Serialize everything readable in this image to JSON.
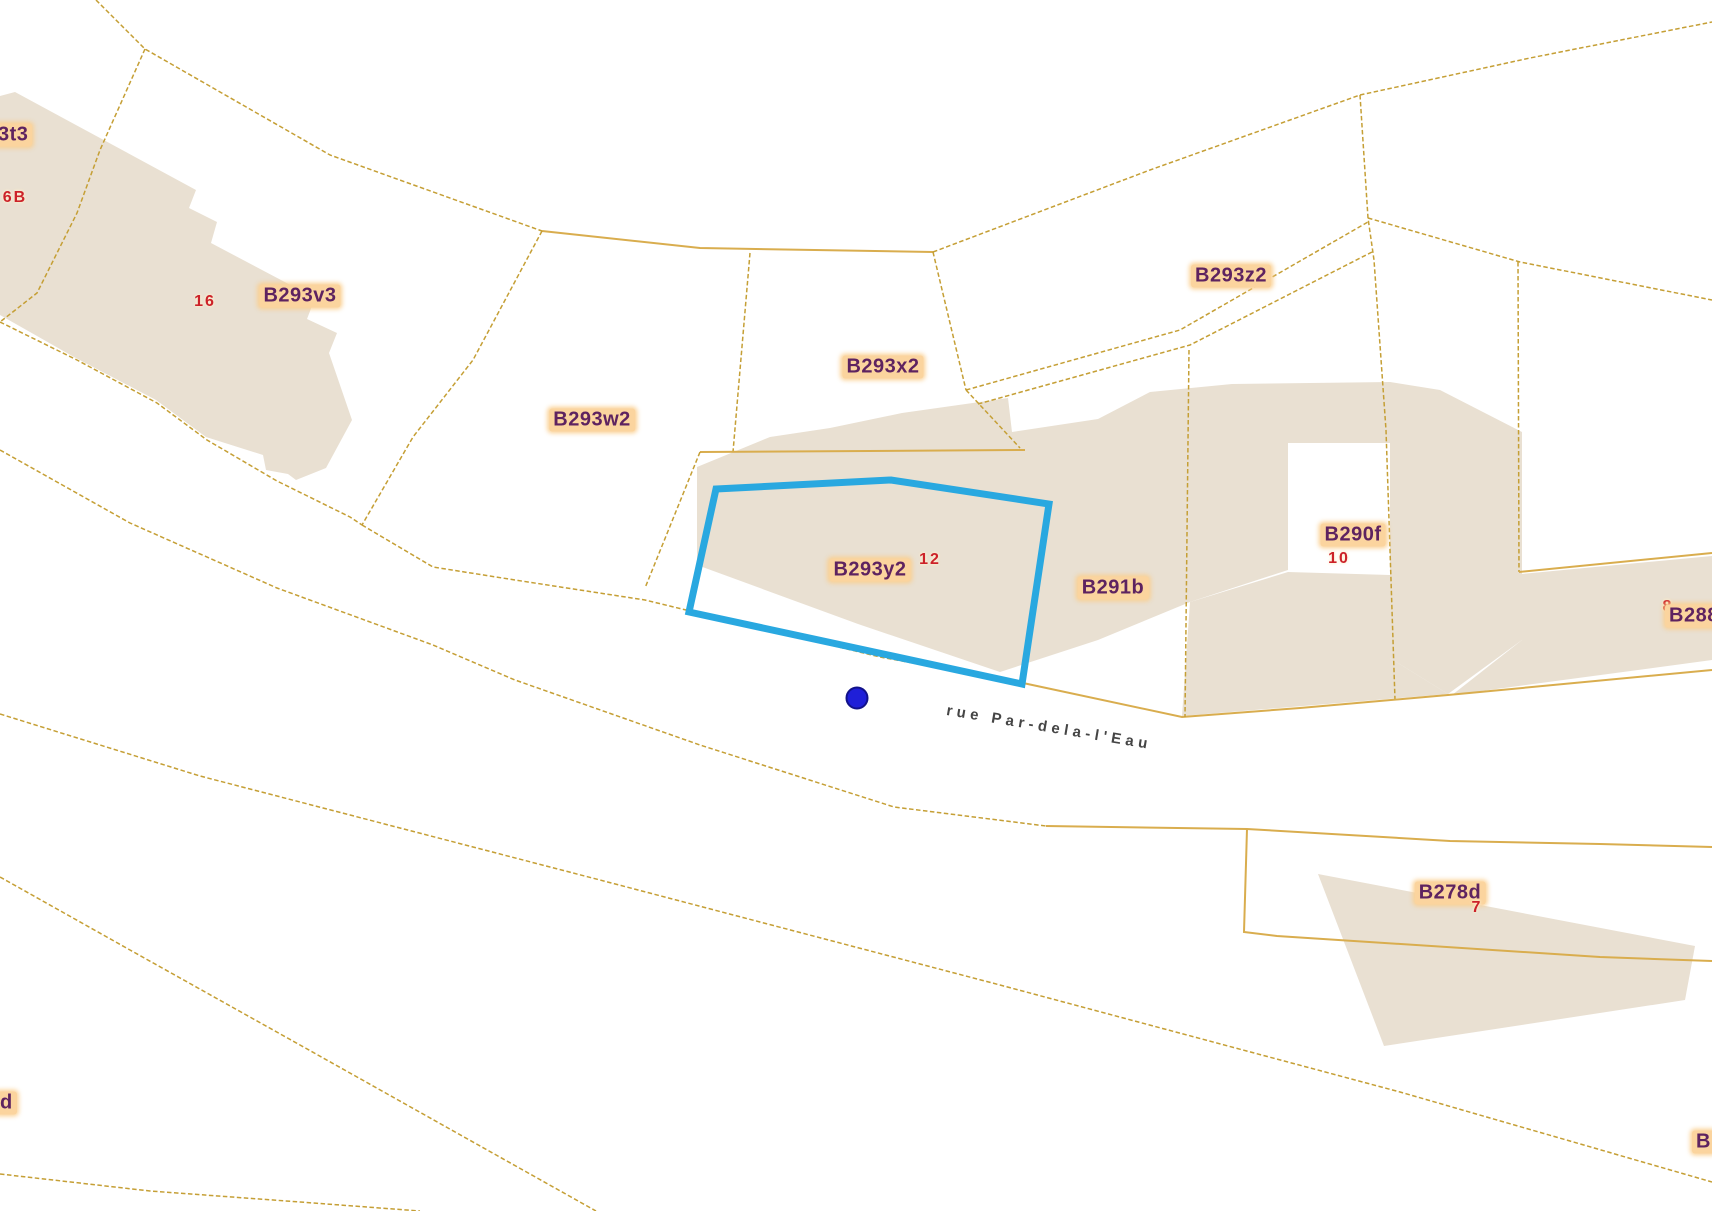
{
  "map": {
    "title": "cadastral-parcel-map",
    "colors": {
      "background": "#ffffff",
      "building_fill": "#e9e0d2",
      "boundary_line": "#c59f35",
      "boundary_line_solid": "#d9ad4e",
      "parcel_label_text": "#5e2360",
      "parcel_label_bg": "#fbd49e",
      "house_number_text": "#cc2229",
      "street_text": "#454545",
      "highlight_outline": "#29a8e0",
      "marker_fill": "#1f1fd8",
      "marker_border": "#12128a"
    },
    "street": {
      "name": "rue Par-dela-l'Eau",
      "x": 948,
      "y": 702,
      "rotation_deg": 9.5
    },
    "marker": {
      "x": 857,
      "y": 698,
      "radius": 11
    },
    "selected_parcel": {
      "id": "B293y2",
      "outline_points": "716,489 891,480 1049,504 1022,684 689,612",
      "stroke_width": 7
    },
    "labels": [
      {
        "id": "parcel-b293t3-partial",
        "kind": "parcel",
        "text": "3t3",
        "x": -6,
        "y": 135,
        "align": "left"
      },
      {
        "id": "house-6b",
        "kind": "house",
        "text": "6B",
        "x": 15,
        "y": 198,
        "align": "center"
      },
      {
        "id": "house-16",
        "kind": "house",
        "text": "16",
        "x": 205,
        "y": 302,
        "align": "center"
      },
      {
        "id": "parcel-b293v3",
        "kind": "parcel",
        "text": "B293v3",
        "x": 300,
        "y": 296,
        "align": "center"
      },
      {
        "id": "parcel-b293w2",
        "kind": "parcel",
        "text": "B293w2",
        "x": 592,
        "y": 420,
        "align": "center"
      },
      {
        "id": "parcel-b293x2",
        "kind": "parcel",
        "text": "B293x2",
        "x": 883,
        "y": 367,
        "align": "center"
      },
      {
        "id": "parcel-b293z2",
        "kind": "parcel",
        "text": "B293z2",
        "x": 1231,
        "y": 276,
        "align": "center"
      },
      {
        "id": "parcel-b293y2",
        "kind": "parcel",
        "text": "B293y2",
        "x": 870,
        "y": 570,
        "align": "center"
      },
      {
        "id": "house-12",
        "kind": "house",
        "text": "12",
        "x": 930,
        "y": 560,
        "align": "center"
      },
      {
        "id": "parcel-b291b",
        "kind": "parcel",
        "text": "B291b",
        "x": 1113,
        "y": 588,
        "align": "center"
      },
      {
        "id": "parcel-b290f",
        "kind": "parcel",
        "text": "B290f",
        "x": 1353,
        "y": 535,
        "align": "center"
      },
      {
        "id": "house-10",
        "kind": "house",
        "text": "10",
        "x": 1339,
        "y": 559,
        "align": "center"
      },
      {
        "id": "house-8",
        "kind": "house",
        "text": "8",
        "x": 1668,
        "y": 607,
        "align": "center"
      },
      {
        "id": "parcel-b288-partial",
        "kind": "parcel",
        "text": "B288",
        "x": 1665,
        "y": 616,
        "align": "left"
      },
      {
        "id": "parcel-b278d",
        "kind": "parcel",
        "text": "B278d",
        "x": 1450,
        "y": 893,
        "align": "center"
      },
      {
        "id": "house-7",
        "kind": "house",
        "text": "7",
        "x": 1477,
        "y": 908,
        "align": "center"
      },
      {
        "id": "parcel-d-partial",
        "kind": "parcel",
        "text": "d",
        "x": -4,
        "y": 1103,
        "align": "left"
      },
      {
        "id": "parcel-b-partial",
        "kind": "parcel",
        "text": "B",
        "x": 1692,
        "y": 1142,
        "align": "left"
      }
    ],
    "buildings": [
      {
        "id": "building-top-left",
        "points": "15,92 196,190 189,208 217,222 211,243 315,298 307,319 337,333 329,353 352,420 326,468 296,480 288,474 266,470 263,455 206,437 156,400 74,357 0,315 0,96"
      },
      {
        "id": "building-central",
        "points": "697,467 770,437 830,428 902,413 1008,398 1012,432 1098,419 1098,640 1000,672 858,624 697,565"
      },
      {
        "id": "building-b290f-left",
        "points": "1098,419 1150,392 1232,384 1390,382 1390,443 1288,443 1288,570 1190,602 1098,640"
      },
      {
        "id": "building-b290f-right",
        "points": "1390,382 1440,390 1522,432 1522,640 1448,694 1390,658"
      },
      {
        "id": "building-bottom-band",
        "points": "1190,602 1288,572 1390,575 1390,658 1448,694 1182,716"
      },
      {
        "id": "building-right-strip",
        "points": "1522,574 1712,556 1712,660 1452,695 1522,640"
      },
      {
        "id": "building-b278d",
        "points": "1318,874 1695,946 1685,1000 1384,1046"
      }
    ],
    "boundary_lines": [
      {
        "id": "l1",
        "style": "dashed",
        "points": "96,0 145,49 330,155 542,231"
      },
      {
        "id": "l2",
        "style": "solid",
        "points": "542,231 700,248 933,252"
      },
      {
        "id": "l3",
        "style": "dashed",
        "points": "933,252 1150,170 1360,95"
      },
      {
        "id": "l4",
        "style": "dashed",
        "points": "1360,95 1368,218 1374,260 1386,430 1395,700"
      },
      {
        "id": "l5",
        "style": "dashed",
        "points": "1360,95 1530,58 1712,22"
      },
      {
        "id": "l6",
        "style": "dashed",
        "points": "1368,218 1520,262 1712,300"
      },
      {
        "id": "l7",
        "style": "dashed",
        "points": "750,253 733,452"
      },
      {
        "id": "l8",
        "style": "solid",
        "points": "700,452 1025,450"
      },
      {
        "id": "l9",
        "style": "dashed",
        "points": "700,452 645,588"
      },
      {
        "id": "l10",
        "style": "dashed",
        "points": "542,231 473,360 413,437 362,525"
      },
      {
        "id": "l11",
        "style": "dashed",
        "points": "145,49 100,150 77,213 37,293 0,322"
      },
      {
        "id": "l12",
        "style": "dashed",
        "points": "0,322 77,360 157,403 207,440 277,481 350,517 362,525"
      },
      {
        "id": "l13",
        "style": "dashed",
        "points": "362,525 433,567 515,580 645,600 760,628 880,657 1023,683"
      },
      {
        "id": "l13b",
        "style": "solid",
        "points": "1023,683 1182,717 1300,708 1448,695 1712,670"
      },
      {
        "id": "l14",
        "style": "dashed",
        "points": "0,450 130,523 277,588 433,645 515,680 700,745 894,807 1046,826"
      },
      {
        "id": "l14b",
        "style": "solid",
        "points": "1046,826 1247,829 1450,841 1600,844 1712,847"
      },
      {
        "id": "l15",
        "style": "dashed",
        "points": "0,714 200,776 600,880 1000,985 1400,1092 1712,1182"
      },
      {
        "id": "l16",
        "style": "dashed",
        "points": "0,877 130,950 300,1045 596,1211"
      },
      {
        "id": "l17",
        "style": "dashed",
        "points": "0,1174 150,1191 300,1202 420,1211"
      },
      {
        "id": "l18",
        "style": "solid",
        "points": "1247,829 1244,932 1277,936 1600,957 1712,961"
      },
      {
        "id": "l19",
        "style": "dashed",
        "points": "1518,262 1519,572"
      },
      {
        "id": "l20",
        "style": "solid",
        "points": "1519,572 1712,553"
      },
      {
        "id": "l21",
        "style": "dashed",
        "points": "966,390 1180,330 1368,222"
      },
      {
        "id": "l22",
        "style": "dashed",
        "points": "978,404 1190,345 1372,252"
      },
      {
        "id": "l23",
        "style": "dashed",
        "points": "933,252 966,390"
      },
      {
        "id": "l24",
        "style": "dashed",
        "points": "966,390 1020,448"
      },
      {
        "id": "l25",
        "style": "dashed",
        "points": "1189,350 1185,717"
      }
    ]
  }
}
